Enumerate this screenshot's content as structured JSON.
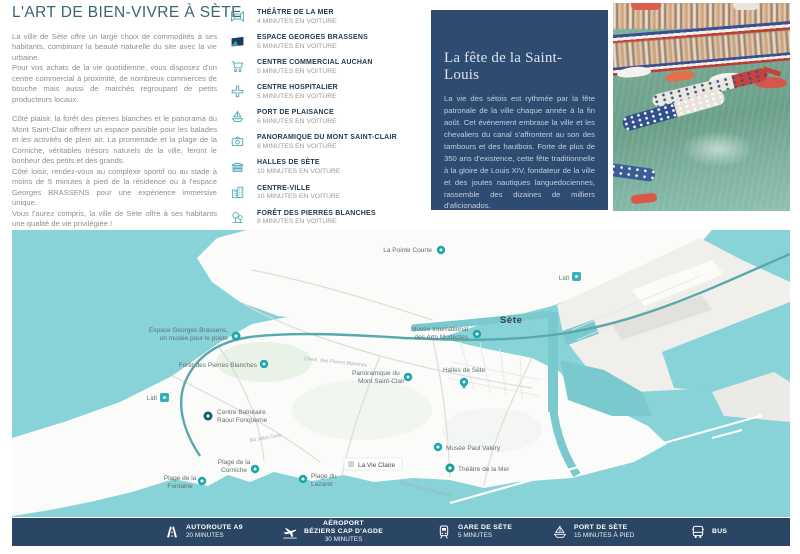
{
  "intro": {
    "title": "L'ART DE BIEN-VIVRE À SÈTE",
    "paragraphs": [
      "La ville de Sète offre un large choix de commodités à ses habitants, combinant la beauté naturelle du site avec la vie urbaine.",
      "Pour vos achats de la vie quotidienne, vous disposez d'un centre commercial à proximité, de nombreux commerces de bouche mais aussi de marchés regroupant de petits producteurs locaux.",
      "Côté plaisir, la forêt des pierres blanches et le panorama du Mont Saint-Clair offrent un espace paisible pour les balades et les activités de plein air. La promenade et la plage de la Corniche, véritables trésors naturels de la ville, feront le bonheur des petits et des grands.",
      "Côté loisir, rendez-vous au complexe sportif ou au stade à moins de 5 minutes à pied de la résidence ou à l'espace Georges BRASSENS pour une expérience immersive unique.",
      "Vous l'aurez compris, la ville de Sète offre à ses habitants une qualité de vie privilégiée !"
    ]
  },
  "amenities": {
    "items": [
      {
        "icon": "theater-icon",
        "label": "THÉÂTRE DE LA MER",
        "time": "4 MINUTES EN VOITURE"
      },
      {
        "icon": "brassens-logo-icon",
        "label": "ESPACE GEORGES BRASSENS",
        "time": "5 MINUTES EN VOITURE"
      },
      {
        "icon": "shopping-cart-icon",
        "label": "CENTRE COMMERCIAL AUCHAN",
        "time": "5 MINUTES EN VOITURE"
      },
      {
        "icon": "medical-cross-icon",
        "label": "CENTRE HOSPITALIER",
        "time": "5 MINUTES EN VOITURE"
      },
      {
        "icon": "sailboat-icon",
        "label": "PORT DE PLAISANCE",
        "time": "6 MINUTES EN VOITURE"
      },
      {
        "icon": "camera-icon",
        "label": "PANORAMIQUE DU MONT SAINT-CLAIR",
        "time": "6 MINUTES EN VOITURE"
      },
      {
        "icon": "market-hall-icon",
        "label": "HALLES DE SÈTE",
        "time": "10 MINUTES EN VOITURE"
      },
      {
        "icon": "buildings-icon",
        "label": "CENTRE-VILLE",
        "time": "10 MINUTES EN VOITURE"
      },
      {
        "icon": "trees-icon",
        "label": "FORÊT DES PIERRES BLANCHES",
        "time": "8 MINUTES EN VOITURE"
      }
    ]
  },
  "feature_box": {
    "title": "La fête de la Saint-Louis",
    "body": "La vie des sétois est rythmée par la fête patronale de la ville chaque année à la fin août. Cet événement embrase la ville et les chevaliers du canal s'affrontent au son des tambours et des hautbois. Forte de plus de 350 ans d'existence, cette fête traditionnelle à la gloire de Louis XIV, fondateur de la ville et des joutes nautiques languedociennes, rassemble des dizaines de milliers d'aficionados."
  },
  "map": {
    "labels": [
      {
        "name": "la-pointe-courte",
        "lines": [
          "La Pointe Courte"
        ]
      },
      {
        "name": "sete-city",
        "lines": [
          "Sète"
        ]
      },
      {
        "name": "musee-arts-modestes",
        "lines": [
          "Musée International",
          "des Arts Modestes"
        ]
      },
      {
        "name": "halles-de-sete",
        "lines": [
          "Halles de Sète"
        ]
      },
      {
        "name": "lidl-north",
        "lines": [
          "Lidl"
        ]
      },
      {
        "name": "espace-brassens",
        "lines": [
          "Espace Georges Brassens,",
          "un musée pour le poète"
        ]
      },
      {
        "name": "foret-pierres-blanches",
        "lines": [
          "Forêt des Pierres Blanches"
        ]
      },
      {
        "name": "panoramique-mont-saint-clair",
        "lines": [
          "Panoramique du",
          "Mont Saint-Clair"
        ]
      },
      {
        "name": "lidl-west",
        "lines": [
          "Lidl"
        ]
      },
      {
        "name": "centre-balneaire",
        "lines": [
          "Centre Balnéaire",
          "Raoul Fonquerne"
        ]
      },
      {
        "name": "plage-fontaine",
        "lines": [
          "Plage de la",
          "Fontaine"
        ]
      },
      {
        "name": "plage-corniche",
        "lines": [
          "Plage de la",
          "Corniche"
        ]
      },
      {
        "name": "plage-lazaret",
        "lines": [
          "Plage du",
          "Lazaret"
        ]
      },
      {
        "name": "la-vie-claire",
        "lines": [
          "La Vie Claire"
        ]
      },
      {
        "name": "musee-paul-valery",
        "lines": [
          "Musée Paul Valéry"
        ]
      },
      {
        "name": "theatre-de-la-mer",
        "lines": [
          "Théâtre de la Mer"
        ]
      },
      {
        "name": "road-chem-pierres-blanches",
        "lines": [
          "Chem. des Pierres Blanches"
        ]
      },
      {
        "name": "road-bd-joliot-curie",
        "lines": [
          "Bd Joliot Curie"
        ]
      },
      {
        "name": "road-prom-marechal-leclerc",
        "lines": [
          "Prom. Maréchal Leclerc"
        ]
      }
    ]
  },
  "transport": {
    "items": [
      {
        "icon": "highway-icon",
        "label": "AUTOROUTE A9",
        "time": "20 MINUTES"
      },
      {
        "icon": "plane-icon",
        "label": "AÉROPORT",
        "sublabel": "BÉZIERS CAP D'AGDE",
        "time": "30 MINUTES"
      },
      {
        "icon": "train-icon",
        "label": "GARE DE SÈTE",
        "time": "5 MINUTES"
      },
      {
        "icon": "sailboat-icon",
        "label": "PORT DE SÈTE",
        "time": "15 MINUTES À PIED"
      },
      {
        "icon": "bus-icon",
        "label": "BUS"
      }
    ]
  },
  "colors": {
    "accent_teal": "#4aa7b4",
    "navy_box": "#2e4b72",
    "bar_navy": "#2b4565",
    "heading": "#3a6473",
    "map_water": "#87d3d7",
    "pin_teal": "#1ea6b0"
  }
}
